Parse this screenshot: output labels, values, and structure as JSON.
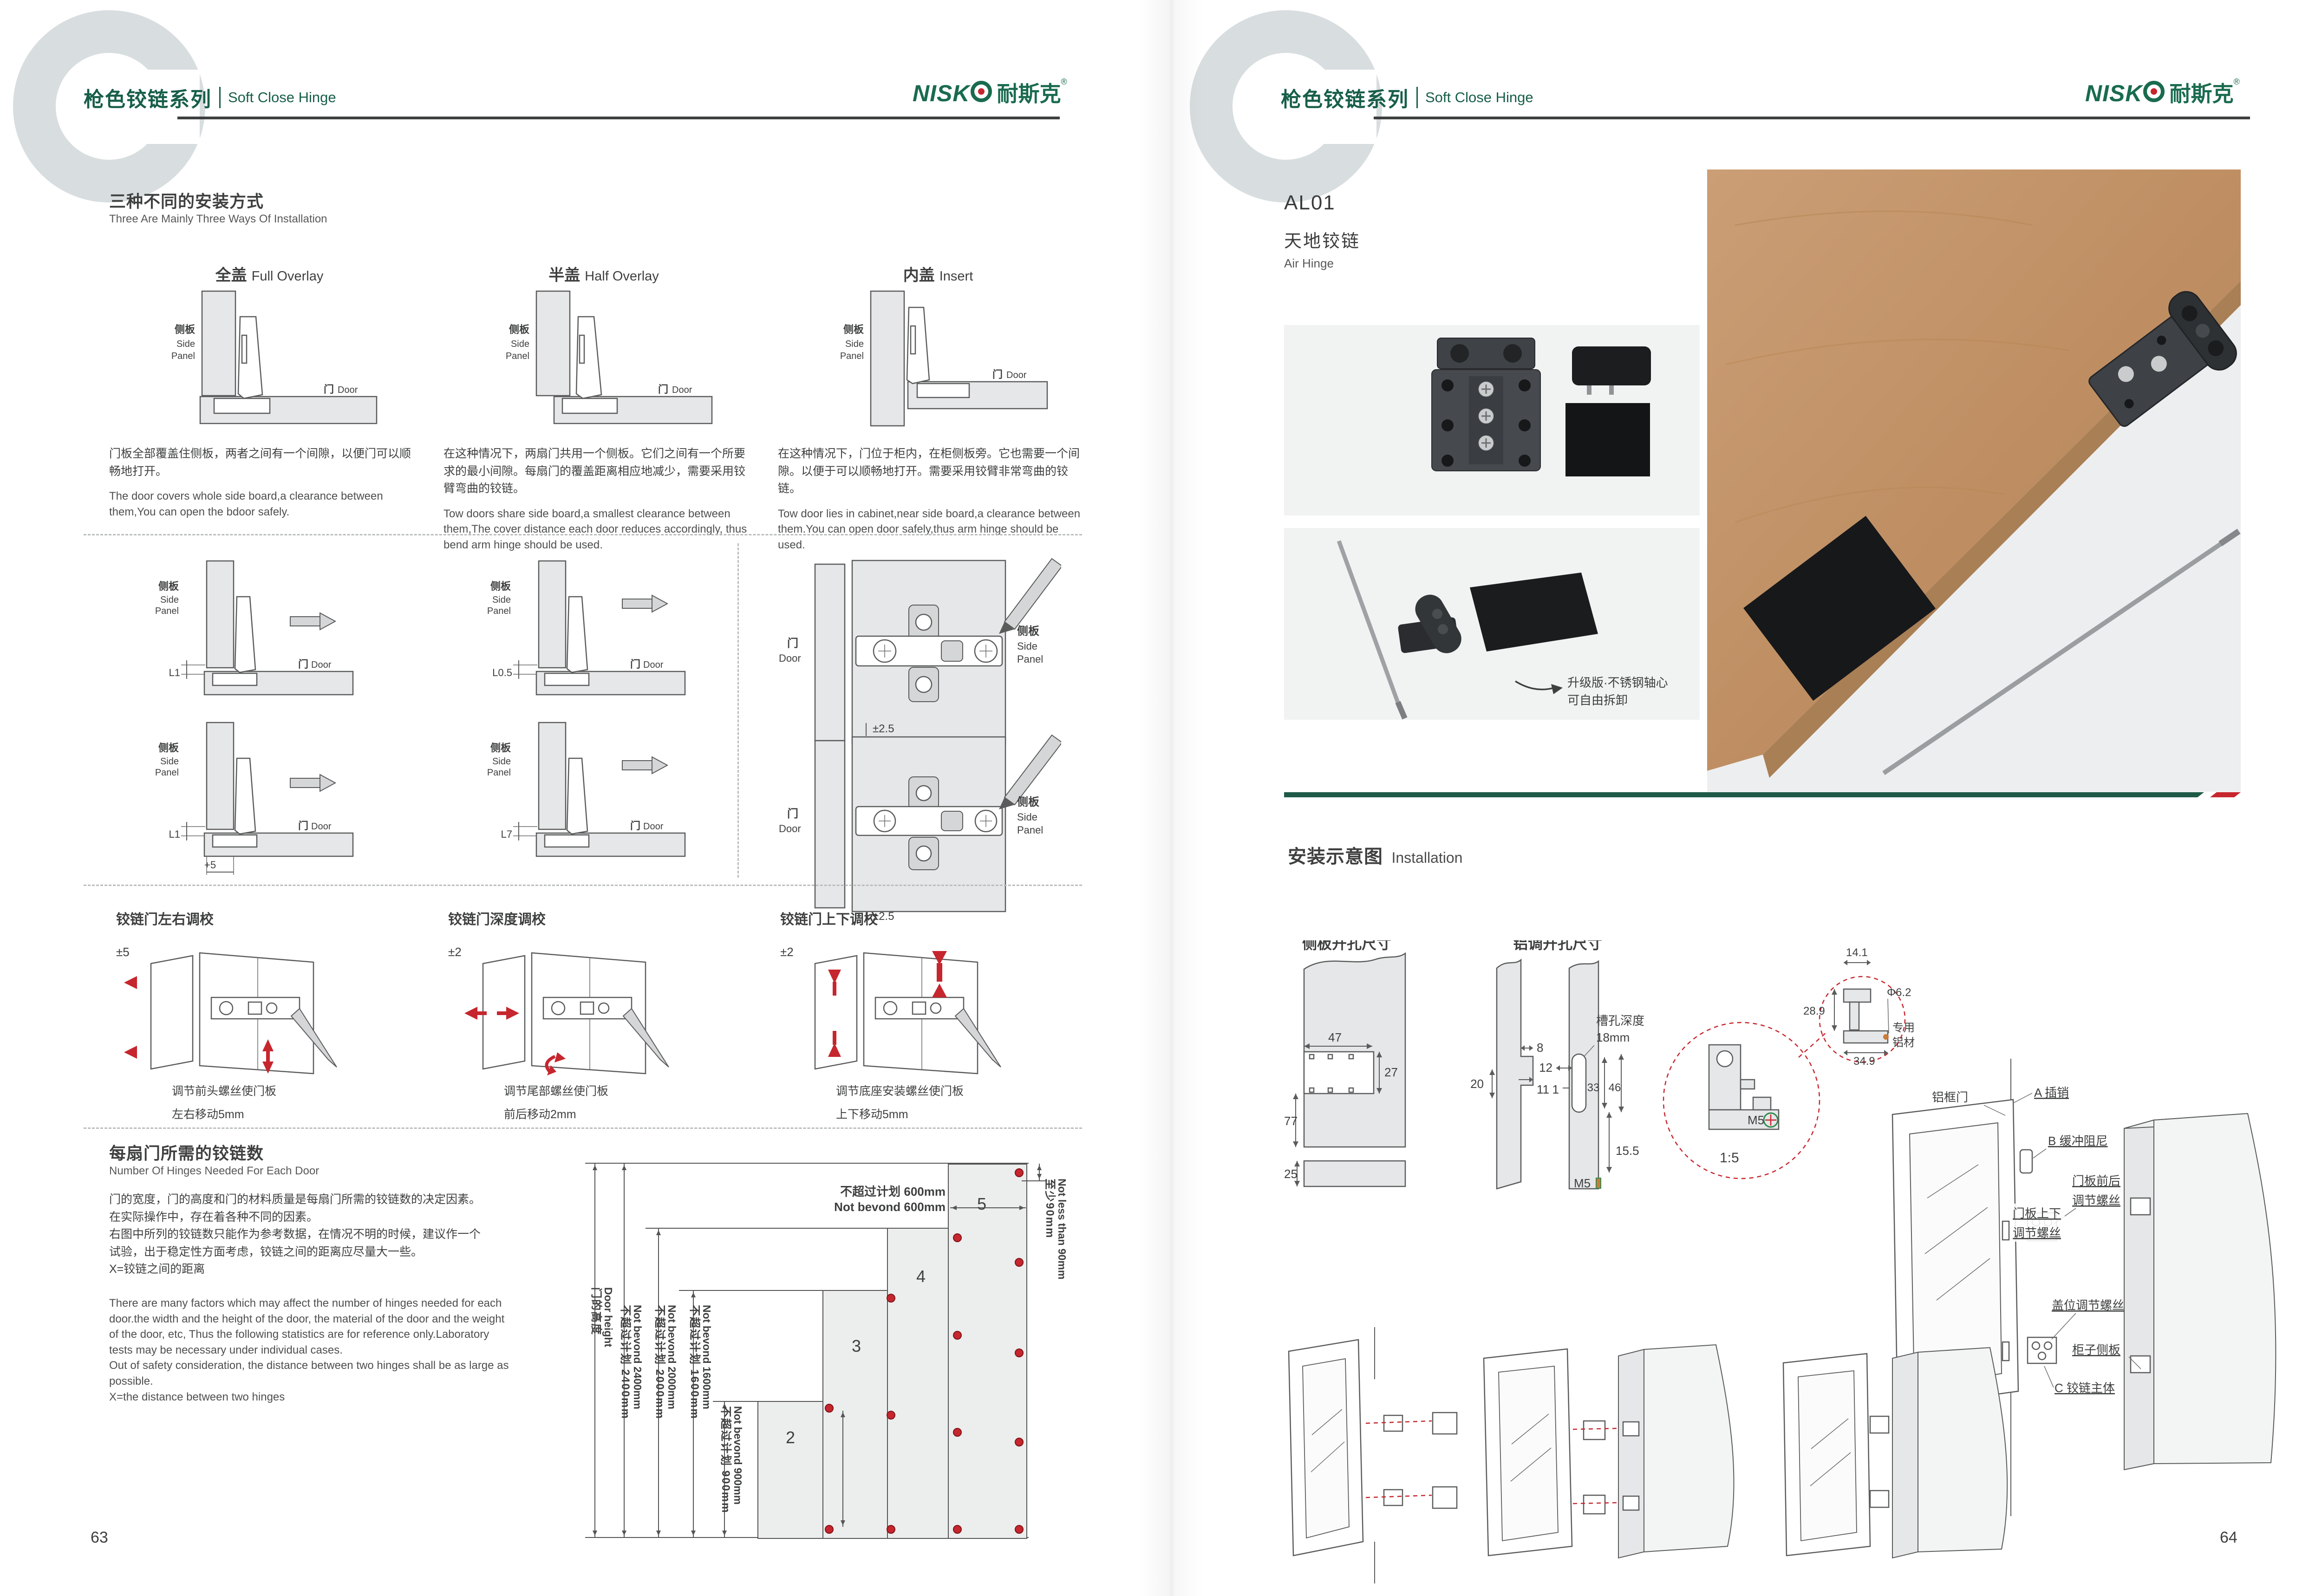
{
  "colors": {
    "brand_green": "#175e48",
    "accent_red": "#c6262e",
    "divider_green": "#1e5a47",
    "rule_dark": "#3e4040",
    "panel_gray": "#e6e7e8"
  },
  "shared": {
    "header": {
      "series_cn": "枪色铰链系列",
      "series_en": "Soft Close Hinge",
      "logo_en": "NISK",
      "logo_cn": "耐斯克",
      "logo_reg": "®",
      "watermark": "C"
    },
    "labels": {
      "side_cn": "侧板",
      "side_en1": "Side",
      "side_en2": "Panel",
      "door_cn": "门",
      "door_en": "Door"
    }
  },
  "left": {
    "install": {
      "title_cn": "三种不同的安装方式",
      "title_en": "Three Are Mainly Three Ways Of Installation",
      "cols": [
        {
          "h_cn": "全盖",
          "h_en": "Full Overlay",
          "cn": "门板全部覆盖住侧板，两者之间有一个间隙，以便门可以顺畅地打开。",
          "en": "The door covers whole side board,a clearance between them,You can open the bdoor safely."
        },
        {
          "h_cn": "半盖",
          "h_en": "Half Overlay",
          "cn": "在这种情况下，两扇门共用一个侧板。它们之间有一个所要求的最小间隙。每扇门的覆盖距离相应地减少，需要采用铰臂弯曲的铰链。",
          "en": "Tow doors share side board,a smallest clearance between them,The cover distance each door reduces accordingly, thus bend arm hinge should be used."
        },
        {
          "h_cn": "内盖",
          "h_en": "Insert",
          "cn": "在这种情况下，门位于柜内，在柜侧板旁。它也需要一个间隙。以便于可以顺畅地打开。需要采用铰臂非常弯曲的铰链。",
          "en": "Tow door lies in cabinet,near side board,a clearance between them.You can open door safely,thus arm hinge should be used."
        }
      ]
    },
    "clearance": {
      "dims": [
        "L1",
        "L0.5",
        "L1",
        "L7"
      ],
      "extra_dim": "+5",
      "updown_dim": "±2.5"
    },
    "adjust": {
      "items": [
        {
          "title": "铰链门左右调校",
          "tol": "±5",
          "cap1": "调节前头螺丝使门板",
          "cap2": "左右移动5mm"
        },
        {
          "title": "铰链门深度调校",
          "tol": "±2",
          "cap1": "调节尾部螺丝使门板",
          "cap2": "前后移动2mm"
        },
        {
          "title": "铰链门上下调校",
          "tol": "±2",
          "cap1": "调节底座安装螺丝使门板",
          "cap2": "上下移动5mm"
        }
      ]
    },
    "hinges": {
      "title_cn": "每扇门所需的铰链数",
      "title_en": "Number Of Hinges Needed For Each Door",
      "cn1": "门的宽度，门的高度和门的材料质量是每扇门所需的铰链数的决定因素。",
      "cn2": "在实际操作中，存在着各种不同的因素。",
      "cn3": "右图中所列的铰链数只能作为参考数据，在情况不明的时候，建议作一个",
      "cn4": "试验，出于稳定性方面考虑，铰链之间的距离应尽量大一些。",
      "cn5": "X=铰链之间的距离",
      "en1": "There are many factors which may affect the number of hinges needed for each",
      "en2": "door.the width and the height of the door, the material of the door and the weight",
      "en3": "of the door, etc, Thus the following statistics are for reference only.Laboratory",
      "en4": "tests may be necessary under individual cases.",
      "en5": "Out of safety consideration, the distance between two hinges shall be as large as",
      "en6": "possible.",
      "en7": "X=the distance between two hinges"
    },
    "chart": {
      "door_height_en": "Door height",
      "door_height_cn": "门的高度",
      "lim2400_en": "Not bevond 2400mm",
      "lim2400_cn": "不超过计划 2400mm",
      "lim2000_en": "Not bevond 2000mm",
      "lim2000_cn": "不超过计划 2000mm",
      "lim1600_en": "Not bevond 1600mm",
      "lim1600_cn": "不超过计划 1600mm",
      "lim900_en": "Not bevond 900mm",
      "lim900_cn": "不超过计划 900mm",
      "lim600_cn": "不超过计划 600mm",
      "lim600_en": "Not bevond 600mm",
      "min90_en": "Not less than 90mm",
      "min90_cn": "至少90mm",
      "bar2": "2",
      "bar3": "3",
      "bar4": "4",
      "bar5": "5"
    },
    "page_number": "63"
  },
  "right": {
    "product": {
      "code": "AL01",
      "name_cn": "天地铰链",
      "name_en": "Air Hinge"
    },
    "note1": "升级版·不锈钢轴心",
    "note2": "可自由拆卸",
    "install": {
      "title_cn": "安装示意图",
      "title_en": "Installation",
      "left_title": "侧板开孔尺寸",
      "right_title": "铝调开孔尺寸",
      "d47": "47",
      "d27": "27",
      "d77": "77",
      "d25": "25",
      "d8": "8",
      "d20": "20",
      "d11": "11",
      "d12": "12",
      "d1": "1",
      "d33": "33",
      "d46": "46",
      "d155": "15.5",
      "m5": "M5",
      "slot1": "槽孔深度",
      "slot2": "18mm",
      "detail_scale": "1:5",
      "detail_m5": "M5",
      "d141": "14.1",
      "d289": "28.9",
      "d349": "34.9",
      "dia": "Φ6.2",
      "alu1": "专用",
      "alu2": "铝材"
    },
    "exploded": {
      "frame": "铝框门",
      "pin": "A 插销",
      "damper": "B 缓冲阻尼",
      "fb1": "门板前后",
      "fb2": "调节螺丝",
      "ud1": "门板上下",
      "ud2": "调节螺丝",
      "cover": "盖位调节螺丝",
      "side": "柜子侧板",
      "body": "C 铰链主体"
    },
    "page_number": "64"
  },
  "chart_data": {
    "type": "bar",
    "title": "每扇门所需的铰链数 Number Of Hinges Needed For Each Door",
    "categories": [
      "door height not beyond 900mm",
      "not beyond 1600mm",
      "not beyond 2000mm",
      "not beyond 2400mm"
    ],
    "values": [
      2,
      3,
      4,
      5
    ],
    "xlabel": "门的高度 Door height",
    "ylabel": "hinges per door",
    "notes": [
      "door width not beyond 600mm",
      "top hinge distance from edge not less than 90mm",
      "X = distance between two hinges"
    ]
  }
}
